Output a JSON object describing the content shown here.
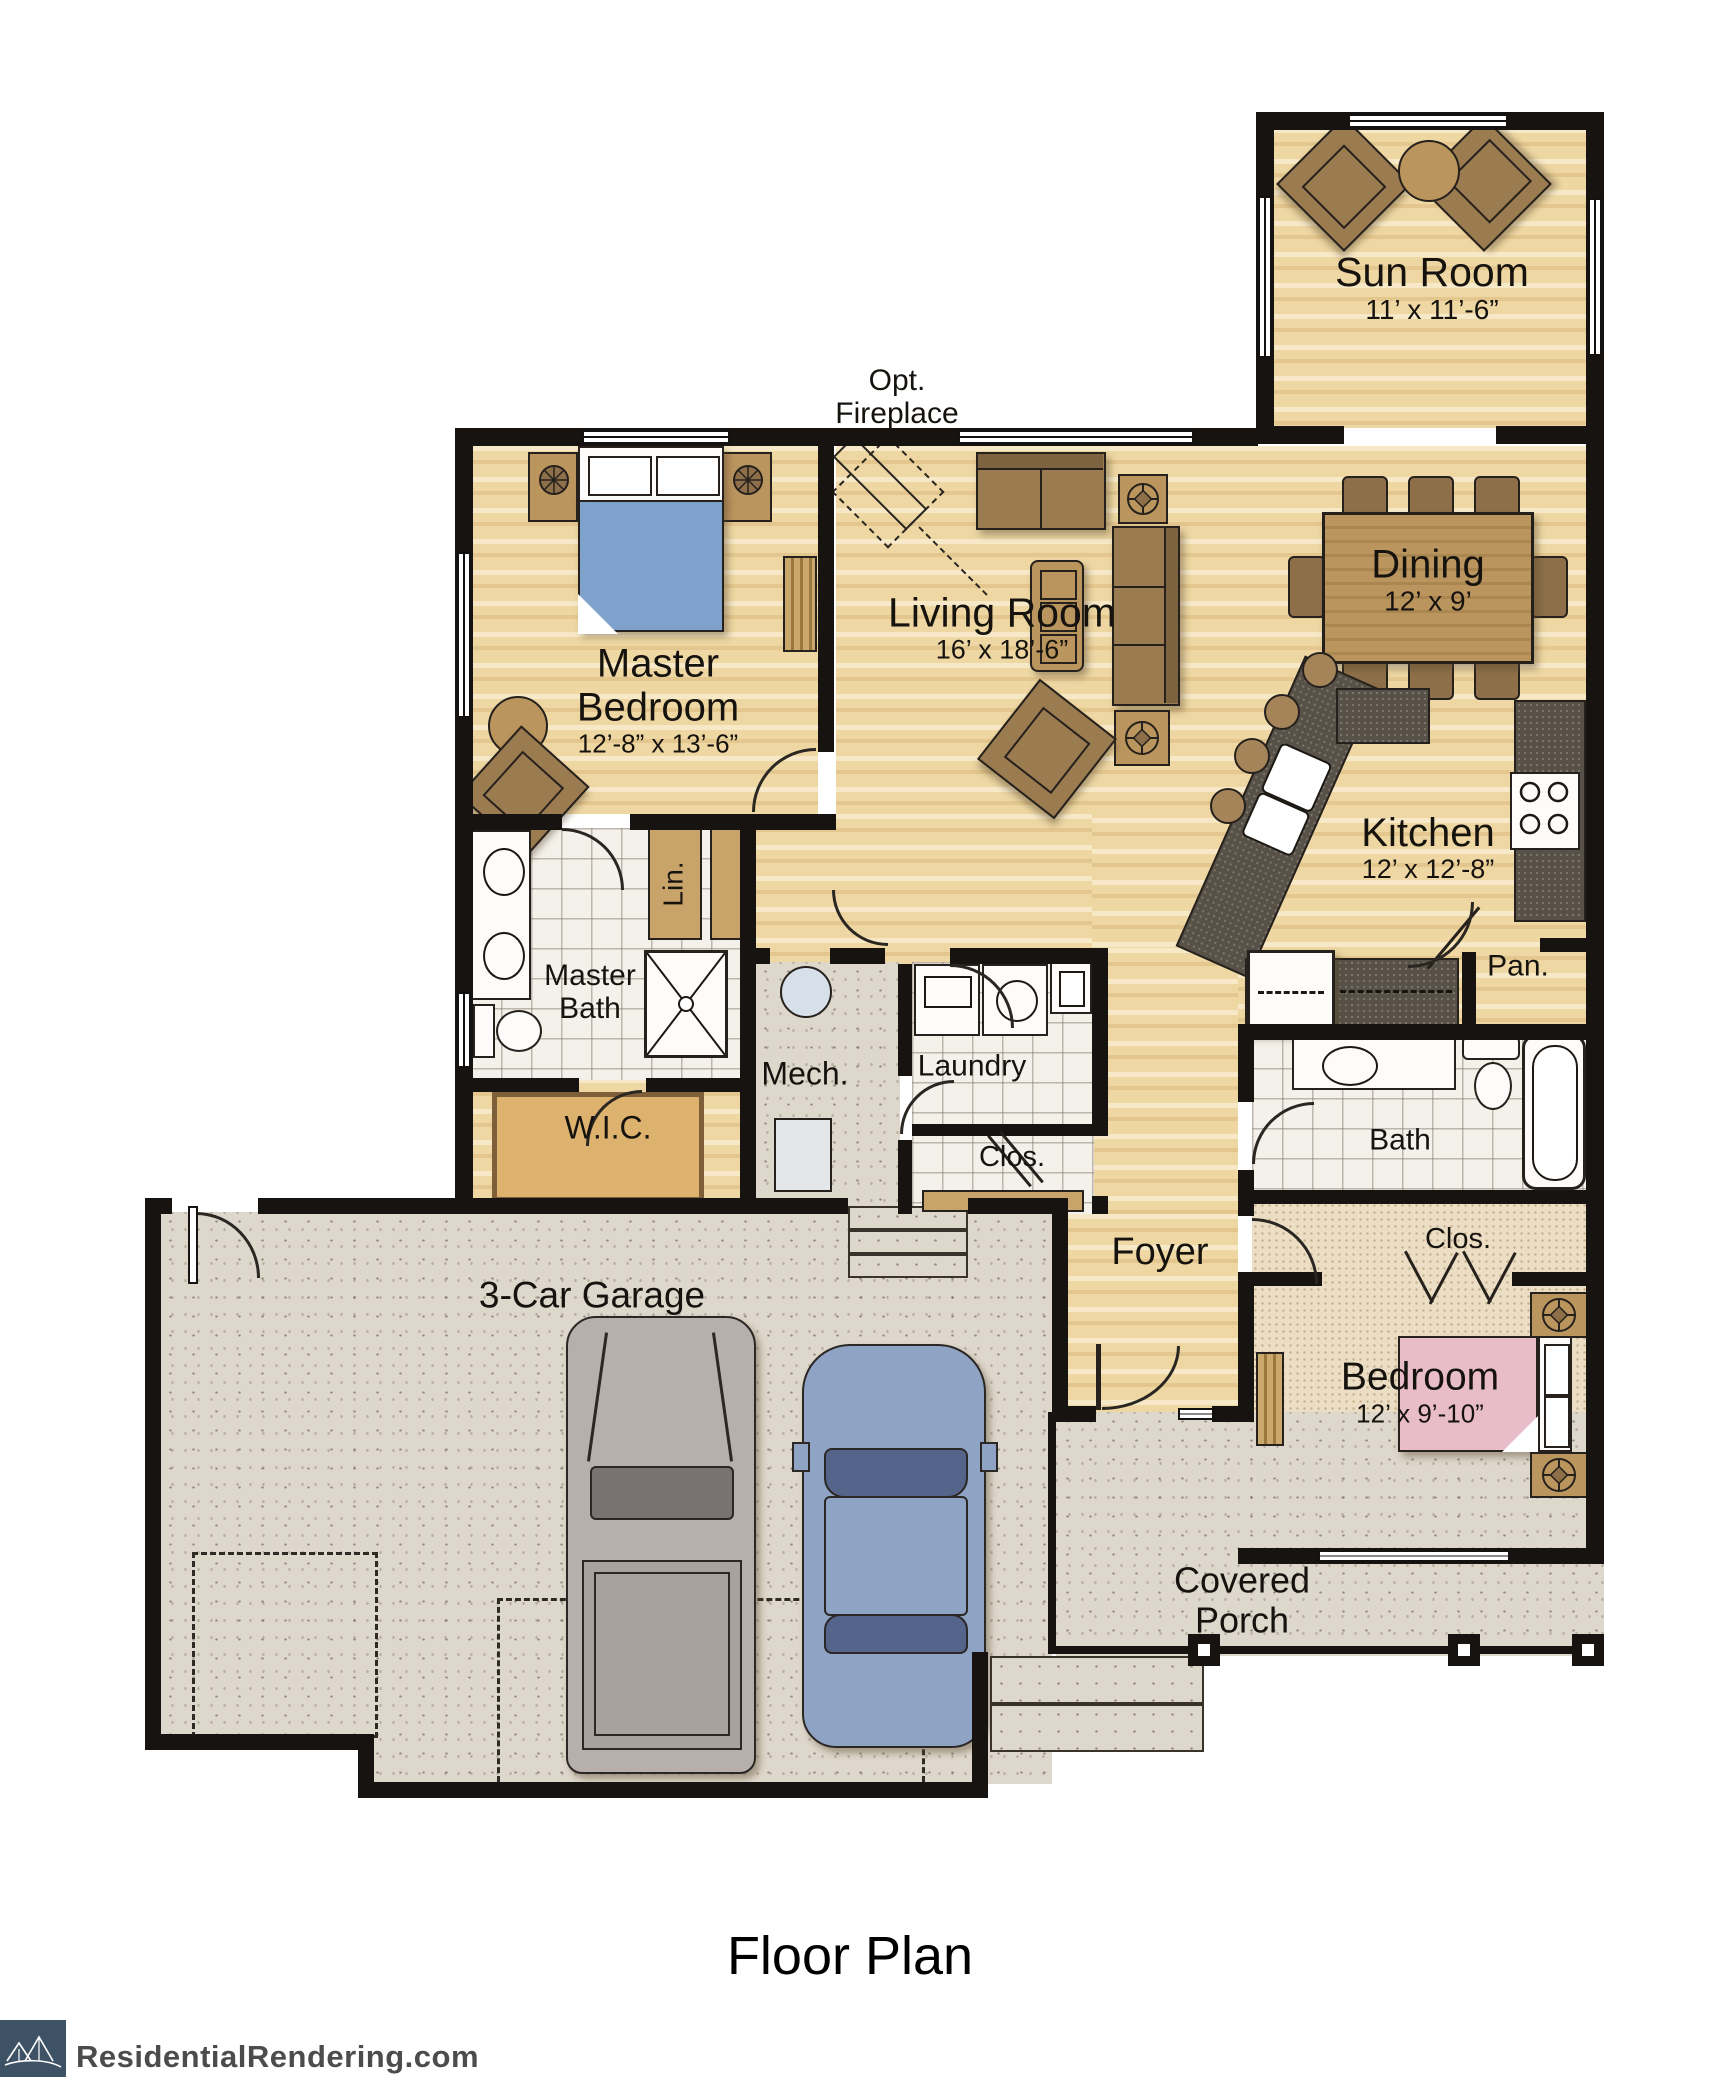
{
  "title": "Floor Plan",
  "branding": {
    "site": "ResidentialRendering.com",
    "logo_color": "#3d5264"
  },
  "annotations": {
    "opt_fireplace": "Opt. Fireplace"
  },
  "rooms": {
    "sun_room": {
      "name": "Sun Room",
      "dims": "11’ x 11’-6”"
    },
    "living_room": {
      "name": "Living Room",
      "dims": "16’ x 18’-6”"
    },
    "master_bedroom": {
      "name": "Master Bedroom",
      "dims": "12’-8” x 13’-6”"
    },
    "dining": {
      "name": "Dining",
      "dims": "12’ x 9’"
    },
    "kitchen": {
      "name": "Kitchen",
      "dims": "12’ x 12’-8”"
    },
    "pantry": {
      "name": "Pan."
    },
    "master_bath": {
      "name": "Master Bath"
    },
    "linen": {
      "name": "Lin."
    },
    "wic": {
      "name": "W.I.C."
    },
    "mech": {
      "name": "Mech."
    },
    "laundry": {
      "name": "Laundry"
    },
    "hall_closet": {
      "name": "Clos."
    },
    "bath": {
      "name": "Bath"
    },
    "foyer": {
      "name": "Foyer"
    },
    "bedroom_closet": {
      "name": "Clos."
    },
    "bedroom": {
      "name": "Bedroom",
      "dims": "12’ x 9’-10”"
    },
    "garage": {
      "name": "3-Car Garage"
    },
    "covered_porch": {
      "name": "Covered Porch"
    }
  },
  "colors": {
    "wall": "#171310",
    "wood": "#eed7a3",
    "tile": "#f4f1ea",
    "carpet": "#ebdec4",
    "concrete": "#ded7cb",
    "countertop": "#575148",
    "master_bed": "#7fa2cc",
    "guest_bed": "#e8bcc8",
    "furniture": "#9b7b50"
  }
}
